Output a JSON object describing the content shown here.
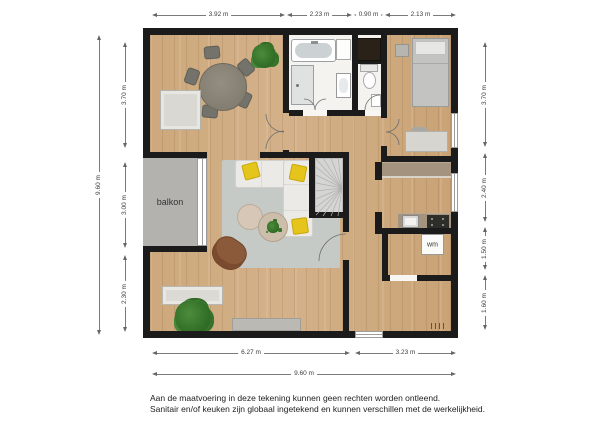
{
  "plan": {
    "balcony_label": "balkon",
    "washer_label": "wm"
  },
  "dimensions": {
    "top": [
      "3.92 m",
      "2.23 m",
      "0.90 m",
      "2.13 m"
    ],
    "left_outer": "9.60 m",
    "left_inner": [
      "3.70 m",
      "3.00 m",
      "2.30 m"
    ],
    "right": [
      "3.70 m",
      "2.40 m",
      "1.50 m",
      "1.60 m"
    ],
    "bottom_inner": [
      "6.27 m",
      "3.23 m"
    ],
    "bottom_outer": "9.60 m"
  },
  "footer": {
    "line1": "Aan de maatvoering in deze tekening kunnen geen rechten worden ontleend.",
    "line2": "Sanitair en/of keuken zijn globaal ingetekend en kunnen verschillen met de werkelijkheid."
  },
  "colors": {
    "wall": "#1b1b1b",
    "wood_floor": "#cda87c",
    "balcony": "#b4b2ae",
    "bathroom_floor": "#f4f3f0",
    "rug": "#c6cac6",
    "sofa": "#eceae6",
    "pillow_yellow": "#e5c41c",
    "plant_green": "#3b7a2c",
    "stairs": "#d5d5d3",
    "kitchen_counter": "#a3937f",
    "cooktop": "#2d2d2a",
    "armchair_brown": "#8b5a3a"
  }
}
